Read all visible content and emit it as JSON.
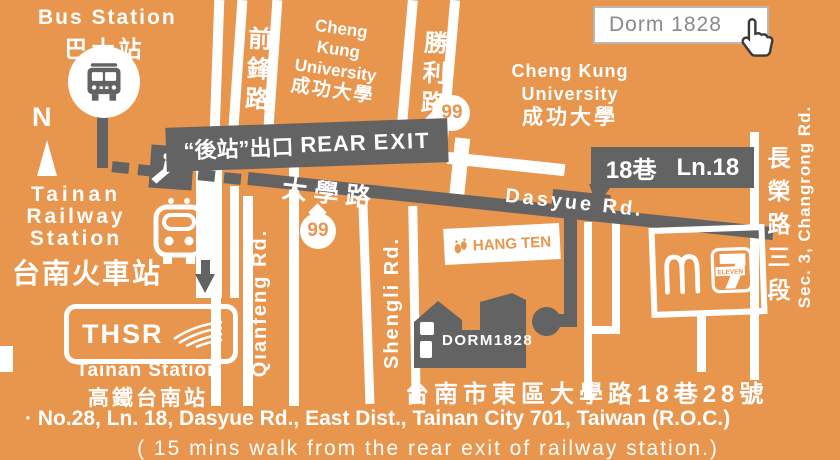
{
  "search_box": {
    "value": "Dorm 1828"
  },
  "compass": {
    "n": "N"
  },
  "bus_station": {
    "en": "Bus Station",
    "zh": "巴士站"
  },
  "top_roads": {
    "qianfeng_zh": "前鋒路",
    "shengli_zh": "勝利路"
  },
  "ncku_top": {
    "l1": "Cheng",
    "l2": "Kung",
    "l3": "University",
    "l4": "成功大學"
  },
  "ncku_right": {
    "l1": "Cheng Kung",
    "l2": "University",
    "l3": "成功大學"
  },
  "banner": {
    "zh": "“後站”出口",
    "en_bold": "REAR",
    "en": "EXIT"
  },
  "route99": {
    "label": "99"
  },
  "dasyue_rd": {
    "zh": "大學路",
    "en": "Dasyue Rd."
  },
  "lane18": {
    "zh": "18巷",
    "en": "Ln.18"
  },
  "changrong_rd": {
    "zh": "長榮路三段",
    "en": "Sec. 3, Changrong Rd."
  },
  "railway_station": {
    "en1": "Tainan",
    "en2": "Railway",
    "en3": "Station",
    "zh": "台南火車站"
  },
  "qianfeng_rd_en": "Qianfeng Rd.",
  "shengli_rd_en": "Shengli Rd.",
  "hang_ten": {
    "label": "HANG TEN"
  },
  "thsr": {
    "label": "THSR",
    "en": "Tainan Station",
    "zh": "高鐵台南站"
  },
  "seven_eleven": {
    "eleven": "ELEVEN"
  },
  "dorm_building": {
    "label": "DORM1828"
  },
  "address": {
    "zh": "台南市東區大學路18巷28號",
    "en": "· No.28, Ln. 18, Dasyue Rd., East Dist., Tainan City 701, Taiwan (R.O.C.)",
    "note": "( 15 mins walk from the rear exit of railway station.)"
  },
  "colors": {
    "background": "#E8954E",
    "dark": "#636363",
    "white": "#FFFFFF",
    "search_text": "#8A8A8A"
  }
}
